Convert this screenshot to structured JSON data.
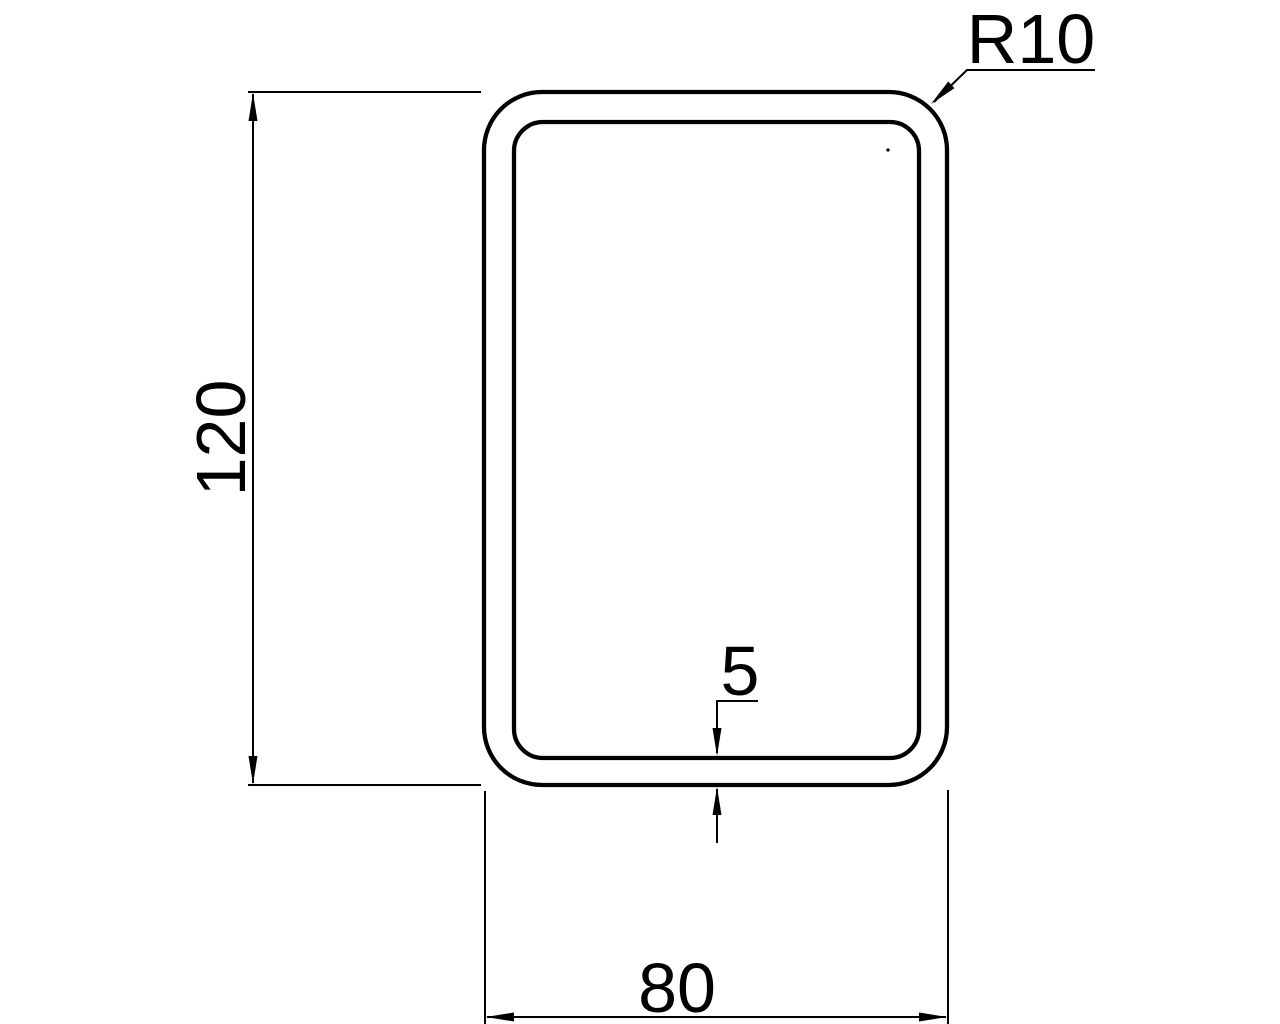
{
  "drawing": {
    "type": "technical-cross-section-rounded-rectangular-tube",
    "background_color": "#ffffff",
    "line_color": "#000000",
    "labels": {
      "height": "120",
      "width": "80",
      "wall_thickness": "5",
      "corner_radius": "R10"
    }
  }
}
